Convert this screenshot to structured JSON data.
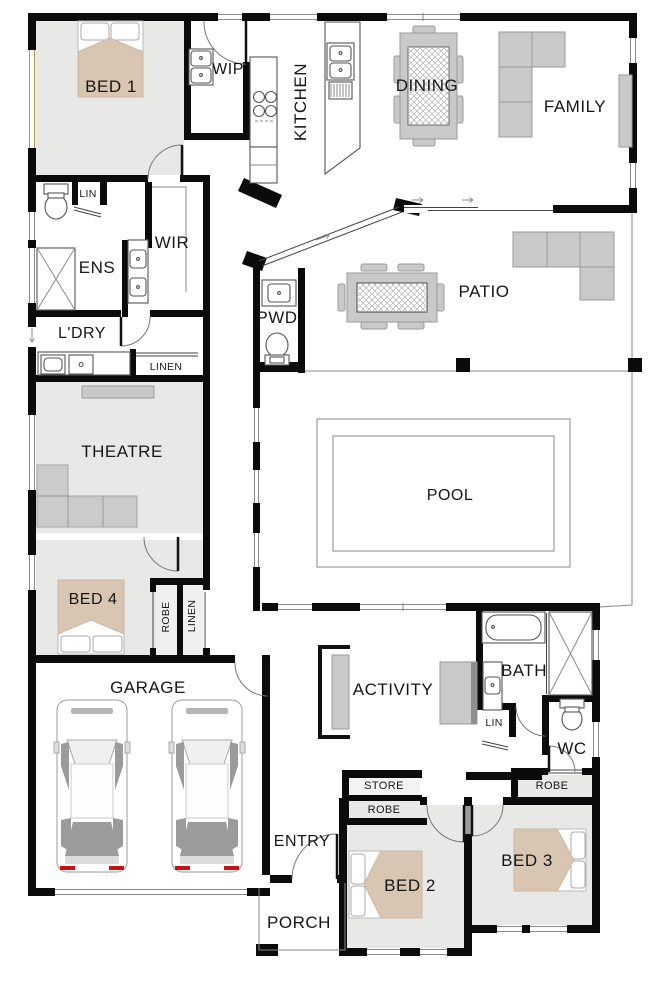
{
  "labels": {
    "bed1": "BED 1",
    "wip": "WIP",
    "kitchen": "KITCHEN",
    "dining": "DINING",
    "family": "FAMILY",
    "lin_ens": "LIN",
    "ens": "ENS",
    "wir": "WIR",
    "pwd": "PWD",
    "patio": "PATIO",
    "ldry": "L'DRY",
    "linen_hall": "LINEN",
    "theatre": "THEATRE",
    "pool": "POOL",
    "bed4": "BED 4",
    "robe_bed4": "ROBE",
    "linen_bed4": "LINEN",
    "garage": "GARAGE",
    "activity": "ACTIVITY",
    "bath": "BATH",
    "lin_bath": "LIN",
    "wc": "WC",
    "store": "STORE",
    "robe_bed2": "ROBE",
    "robe_bed3": "ROBE",
    "entry": "ENTRY",
    "porch": "PORCH",
    "bed2": "BED 2",
    "bed3": "BED 3"
  },
  "colors": {
    "wall": "#0b0b0b",
    "carpet": "#e8e8e7",
    "bed": "#d9c6b2",
    "furniture": "#c9c9c9",
    "window_tint": "#b8954f"
  }
}
